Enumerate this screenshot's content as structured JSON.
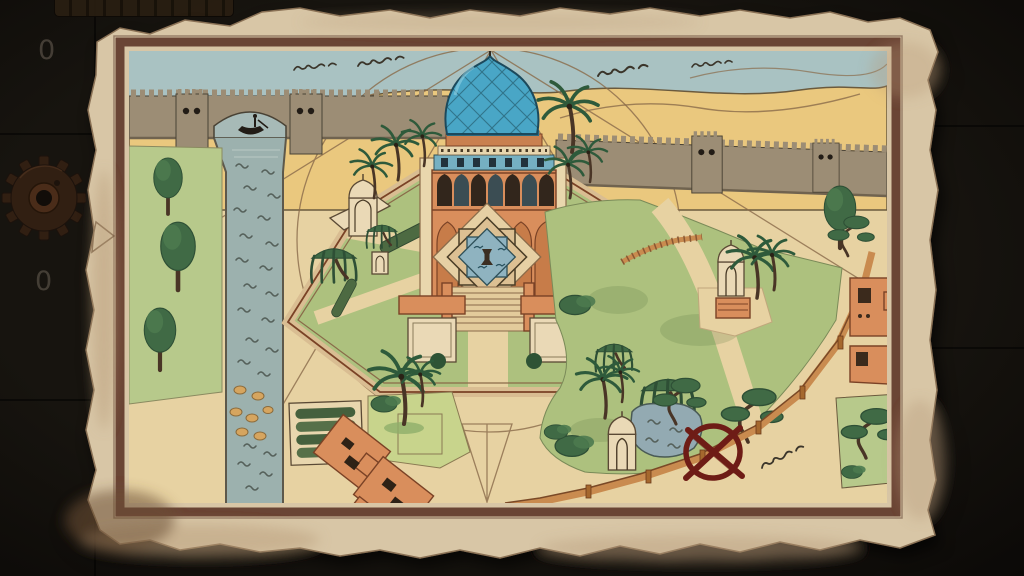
{
  "hud": {
    "counter_top": "0",
    "counter_bottom": "0"
  },
  "palette": {
    "bg": "#17140f",
    "hud_text": "#474138",
    "gear_rust": "#311f12",
    "gear_hub": "#4a2c19",
    "parchment": "#d8c6a6",
    "parchment_edge": "#b59877",
    "frame_brown": "#6b4434",
    "map_sand": "#e7d2a2",
    "dune_sand": "#eac87e",
    "sky_blue": "#a9c2c2",
    "wall_taupe": "#9c8d74",
    "river_blue": "#9cb1ae",
    "water_ink": "#55605a",
    "grass_green": "#b7c98b",
    "garden_green": "#adc17e",
    "tree_green": "#3f6a45",
    "palm_green": "#2f5a3a",
    "trunk_brown": "#4a3526",
    "building_orange": "#d98e5b",
    "building_line": "#7a4226",
    "dome_blue": "#4aa6c6",
    "dome_dark": "#1d4a5c",
    "cream": "#ead9b6",
    "fountain_water": "#8fb3c0",
    "red_mark": "#6e1e15",
    "line_brown": "#8a6b4a",
    "fence_orange": "#c98b4f",
    "ink": "#4a4234"
  },
  "map": {
    "kind": "hand-drawn garden map on torn parchment",
    "features": [
      "city-wall",
      "watchtowers",
      "bridge-arch",
      "boat",
      "river",
      "mausoleum",
      "blue-dome",
      "star-fountain",
      "stairs",
      "kiosks",
      "garden-terrace",
      "gazebos",
      "pond",
      "red-x-mark",
      "boundary-fence",
      "palm-trees",
      "willow-trees",
      "hedge-garden",
      "market-buildings",
      "construction-lines",
      "script-annotations",
      "dunes",
      "sky"
    ]
  }
}
